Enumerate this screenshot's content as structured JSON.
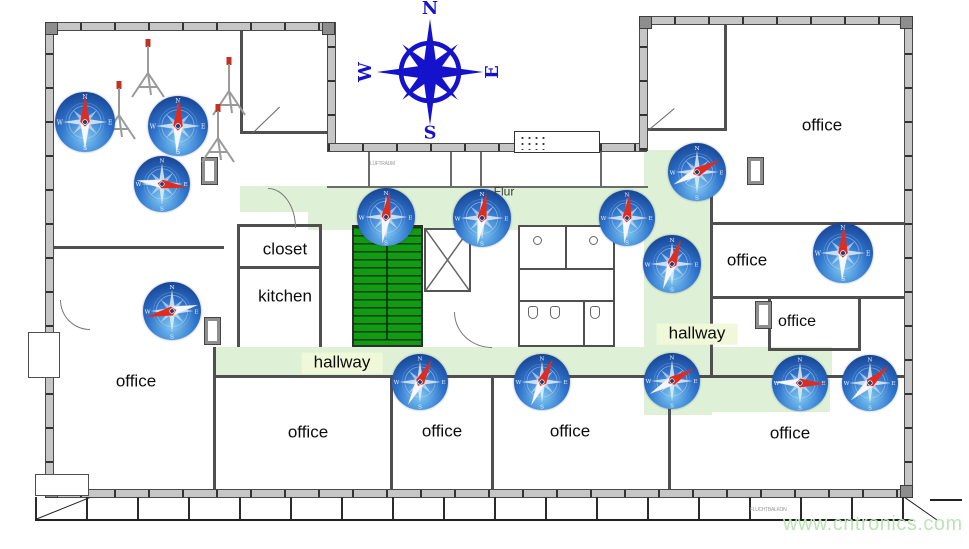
{
  "page": {
    "width": 969,
    "height": 549,
    "background": "#ffffff"
  },
  "compass_rose": {
    "n": "N",
    "e": "E",
    "s": "S",
    "w": "W"
  },
  "compass_icon_letters": {
    "n": "N",
    "e": "E",
    "s": "S",
    "w": "W"
  },
  "floorplan": {
    "room_labels": [
      {
        "label": "office",
        "x": 136,
        "y": 382
      },
      {
        "label": "office",
        "x": 308,
        "y": 433
      },
      {
        "label": "office",
        "x": 442,
        "y": 432
      },
      {
        "label": "office",
        "x": 570,
        "y": 432
      },
      {
        "label": "office",
        "x": 790,
        "y": 434
      },
      {
        "label": "office",
        "x": 822,
        "y": 126
      },
      {
        "label": "office",
        "x": 747,
        "y": 261
      },
      {
        "label": "office",
        "x": 797,
        "y": 322,
        "size": 16
      },
      {
        "label": "closet",
        "x": 285,
        "y": 250
      },
      {
        "label": "kitchen",
        "x": 285,
        "y": 297
      },
      {
        "label": "hallway",
        "x": 342,
        "y": 363,
        "hl": true
      },
      {
        "label": "hallway",
        "x": 697,
        "y": 334,
        "hl": true
      },
      {
        "label": "Flur",
        "x": 504,
        "y": 192,
        "size": 12,
        "color": "#3d3d3d"
      }
    ],
    "vent_label": "LÜFTRAUM",
    "terrace_label": "FLUCHTBALKON"
  },
  "compasses": [
    {
      "x": 85,
      "y": 122,
      "size": 60,
      "angle": 0
    },
    {
      "x": 178,
      "y": 126,
      "size": 60,
      "angle": 3
    },
    {
      "x": 162,
      "y": 184,
      "size": 56,
      "angle": 98
    },
    {
      "x": 172,
      "y": 311,
      "size": 58,
      "angle": 257
    },
    {
      "x": 386,
      "y": 217,
      "size": 58,
      "angle": 8
    },
    {
      "x": 482,
      "y": 218,
      "size": 58,
      "angle": 10
    },
    {
      "x": 627,
      "y": 218,
      "size": 56,
      "angle": 6
    },
    {
      "x": 697,
      "y": 172,
      "size": 58,
      "angle": 62
    },
    {
      "x": 672,
      "y": 264,
      "size": 58,
      "angle": 20
    },
    {
      "x": 843,
      "y": 253,
      "size": 60,
      "angle": 2
    },
    {
      "x": 420,
      "y": 382,
      "size": 56,
      "angle": 28
    },
    {
      "x": 542,
      "y": 382,
      "size": 56,
      "angle": 25
    },
    {
      "x": 672,
      "y": 381,
      "size": 56,
      "angle": 60
    },
    {
      "x": 800,
      "y": 383,
      "size": 56,
      "angle": 92
    },
    {
      "x": 870,
      "y": 383,
      "size": 56,
      "angle": 48
    }
  ],
  "tripods": [
    {
      "x": 124,
      "y": 38
    },
    {
      "x": 205,
      "y": 56
    },
    {
      "x": 95,
      "y": 80
    },
    {
      "x": 194,
      "y": 103
    }
  ],
  "colors": {
    "hallway_green": "#def1d6",
    "label_highlight": "#f0f8da",
    "stair_green": "#129b12",
    "wall_fill": "#c6c6c6",
    "compass_blue_dark": "#123a88",
    "compass_blue_mid": "#2f74cc",
    "compass_blue_light": "#7cc8f4",
    "needle_red": "#df2b20",
    "needle_white": "#f5f7fb",
    "rose_blue": "#1512cc",
    "watermark_green": "#bce4b6"
  },
  "watermark": {
    "text": "www.cntronics.com"
  }
}
